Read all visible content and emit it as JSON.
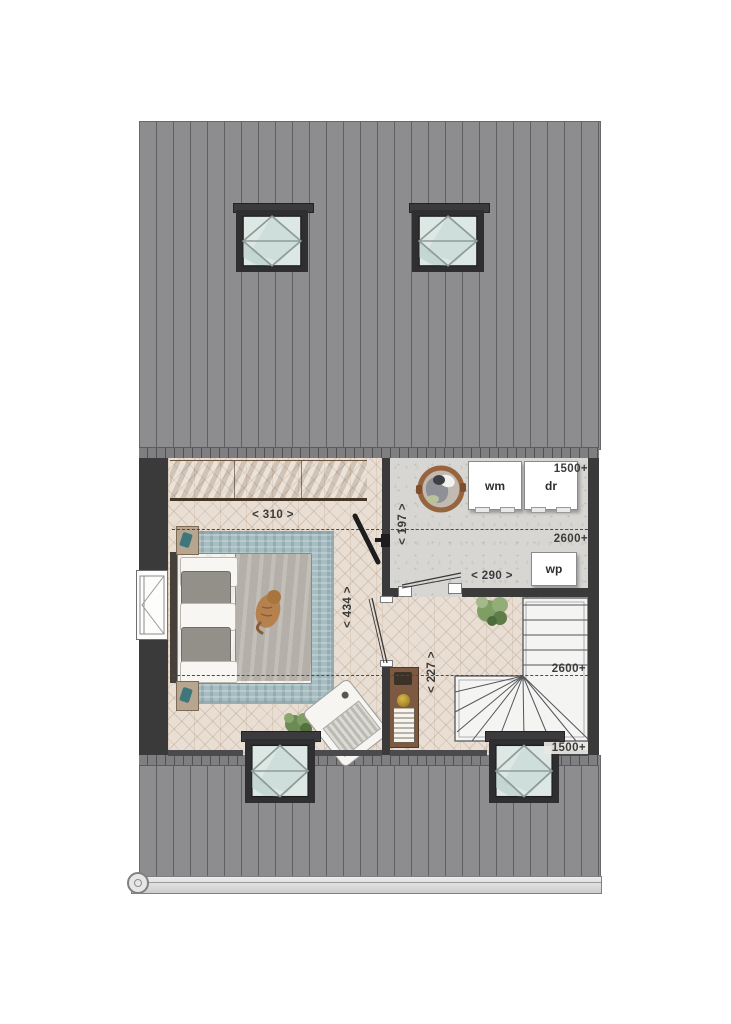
{
  "rooms": {
    "bedroom": {
      "dim_width": "< 310 >",
      "dim_depth": "< 434 >"
    },
    "laundry": {
      "dim_width": "< 290 >",
      "dim_depth": "< 197 >",
      "height_back_wall": "1500+",
      "height_contour": "2600+",
      "washer": "wm",
      "dryer": "dr",
      "heat_pump": "wp"
    },
    "hall": {
      "dim_landing": "< 227 >",
      "height_contour": "2600+",
      "height_front_wall": "1500+"
    }
  },
  "colors": {
    "roof": "#8d8d8f",
    "wall": "#3a3a3b",
    "wood_floor": "#e8ded3",
    "concrete_floor": "#d7d6d3",
    "rug": "#a6bdc2",
    "wardrobe_wood": "#9b7c5f",
    "glass": "#dde8e5",
    "text": "#3b3b3b"
  }
}
